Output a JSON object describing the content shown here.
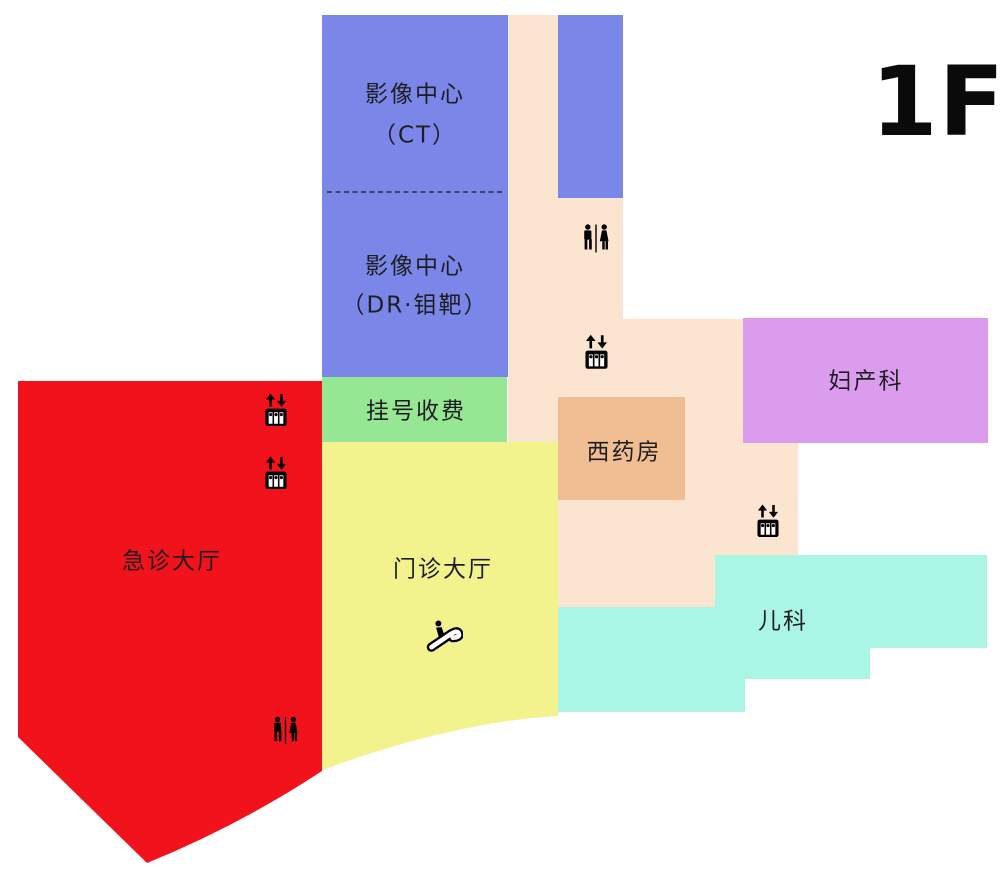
{
  "floor_label": "1F",
  "colors": {
    "imaging_blue": "#7B87E8",
    "corridor_peach": "#FBE5D0",
    "registration_green": "#96E794",
    "emergency_red": "#F2121C",
    "outpatient_yellow": "#F3F38E",
    "pharmacy_orange": "#F0BE92",
    "obstetrics_purple": "#DB9CEE",
    "pediatrics_cyan": "#A9F6E5",
    "icon_black": "#000000"
  },
  "rooms": {
    "imaging_ct": {
      "line1": "影像中心",
      "line2": "（CT）"
    },
    "imaging_dr": {
      "line1": "影像中心",
      "line2": "（DR·钼靶）"
    },
    "registration": {
      "label": "挂号收费"
    },
    "emergency_hall": {
      "label": "急诊大厅"
    },
    "outpatient_hall": {
      "label": "门诊大厅"
    },
    "pharmacy": {
      "label": "西药房"
    },
    "obstetrics": {
      "label": "妇产科"
    },
    "pediatrics": {
      "label": "儿科"
    }
  },
  "icons": {
    "restroom": "restroom-icon",
    "elevator": "elevator-icon",
    "escalator": "escalator-icon"
  }
}
